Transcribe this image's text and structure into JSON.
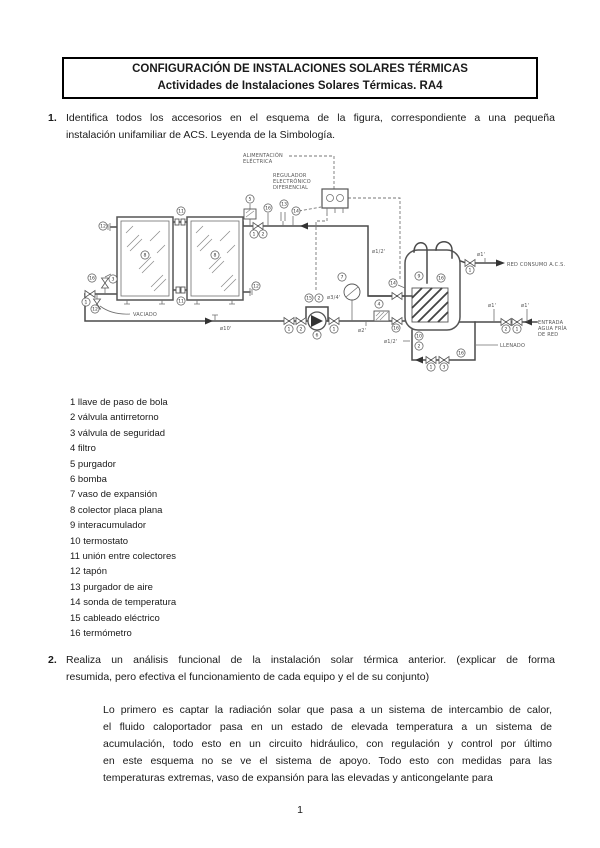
{
  "header": {
    "title_line1": "CONFIGURACIÓN DE INSTALACIONES SOLARES TÉRMICAS",
    "title_line2": "Actividades de Instalaciones Solares Térmicas. RA4"
  },
  "question1": {
    "number": "1.",
    "lines": [
      "Identifica todos los accesorios en el esquema de la figura, correspondiente a una pequeña",
      "instalación unifamiliar de ACS. Leyenda de la Simbología."
    ]
  },
  "legend": {
    "items": [
      "1 llave de paso de bola",
      "2 válvula antirretorno",
      "3 válvula de seguridad",
      "4 filtro",
      "5 purgador",
      "6 bomba",
      "7 vaso de expansión",
      "8 colector placa plana",
      "9 interacumulador",
      "10 termostato",
      "11 unión entre colectores",
      "12 tapón",
      "13 purgador de aire",
      "14 sonda de temperatura",
      "15 cableado eléctrico",
      "16 termómetro"
    ]
  },
  "question2": {
    "number": "2.",
    "lines": [
      "Realiza un análisis funcional de la instalación solar térmica anterior. (explicar de forma",
      "resumida, pero efectiva el funcionamiento de cada equipo y el de su conjunto)"
    ]
  },
  "answer": {
    "lines": [
      "Lo primero es captar la radiación solar que pasa a un sistema de intercambio de calor,",
      "el fluido caloportador pasa en un estado de elevada temperatura a un sistema de",
      "acumulación, todo esto en un circuito hidráulico, con regulación y control por último",
      "en este esquema no se ve el sistema de apoyo. Todo esto con medidas para las",
      "temperaturas extremas, vaso de expansión para las elevadas y anticongelante para"
    ]
  },
  "page": {
    "number": "1"
  },
  "diagram": {
    "labels": {
      "alim_l1": "ALIMENTACIÓN",
      "alim_l2": "ELÉCTRICA",
      "reg_l1": "REGULADOR",
      "reg_l2": "ELECTRÓNICO",
      "reg_l3": "DIFERENCIAL",
      "vaciado": "VACIADO",
      "llenado": "LLENADO",
      "red_consumo": "RED CONSUMO A.C.S.",
      "entrada_l1": "ENTRADA",
      "entrada_l2": "AGUA FRÍA",
      "entrada_l3": "DE RED",
      "d10": "ø10'",
      "d12a": "ø1/2'",
      "d12b": "ø1/2'",
      "d34": "ø3/4'",
      "d2": "ø2'",
      "d1a": "ø1'",
      "d1b": "ø1'",
      "d1c": "ø1'"
    },
    "markers": [
      {
        "n": "12",
        "x": 103,
        "y": 226
      },
      {
        "n": "11",
        "x": 181,
        "y": 211
      },
      {
        "n": "8",
        "x": 145,
        "y": 255
      },
      {
        "n": "8",
        "x": 215,
        "y": 255
      },
      {
        "n": "11",
        "x": 181,
        "y": 301
      },
      {
        "n": "12",
        "x": 256,
        "y": 286
      },
      {
        "n": "16",
        "x": 92,
        "y": 278
      },
      {
        "n": "3",
        "x": 113,
        "y": 279
      },
      {
        "n": "1",
        "x": 86,
        "y": 302
      },
      {
        "n": "12",
        "x": 95,
        "y": 309
      },
      {
        "n": "5",
        "x": 250,
        "y": 199
      },
      {
        "n": "16",
        "x": 268,
        "y": 208
      },
      {
        "n": "13",
        "x": 284,
        "y": 204
      },
      {
        "n": "14",
        "x": 296,
        "y": 211
      },
      {
        "n": "1",
        "x": 254,
        "y": 234
      },
      {
        "n": "2",
        "x": 263,
        "y": 234
      },
      {
        "n": "15",
        "x": 309,
        "y": 298
      },
      {
        "n": "2",
        "x": 319,
        "y": 298
      },
      {
        "n": "7",
        "x": 342,
        "y": 277
      },
      {
        "n": "1",
        "x": 289,
        "y": 329
      },
      {
        "n": "2",
        "x": 301,
        "y": 329
      },
      {
        "n": "6",
        "x": 317,
        "y": 335
      },
      {
        "n": "1",
        "x": 334,
        "y": 329
      },
      {
        "n": "4",
        "x": 379,
        "y": 304
      },
      {
        "n": "16",
        "x": 396,
        "y": 328
      },
      {
        "n": "14",
        "x": 393,
        "y": 283
      },
      {
        "n": "9",
        "x": 419,
        "y": 276
      },
      {
        "n": "16",
        "x": 441,
        "y": 278
      },
      {
        "n": "10",
        "x": 419,
        "y": 336
      },
      {
        "n": "2",
        "x": 419,
        "y": 346
      },
      {
        "n": "1",
        "x": 431,
        "y": 367
      },
      {
        "n": "3",
        "x": 444,
        "y": 367
      },
      {
        "n": "16",
        "x": 461,
        "y": 353
      },
      {
        "n": "1",
        "x": 470,
        "y": 270
      },
      {
        "n": "2",
        "x": 506,
        "y": 329
      },
      {
        "n": "1",
        "x": 517,
        "y": 329
      }
    ]
  }
}
